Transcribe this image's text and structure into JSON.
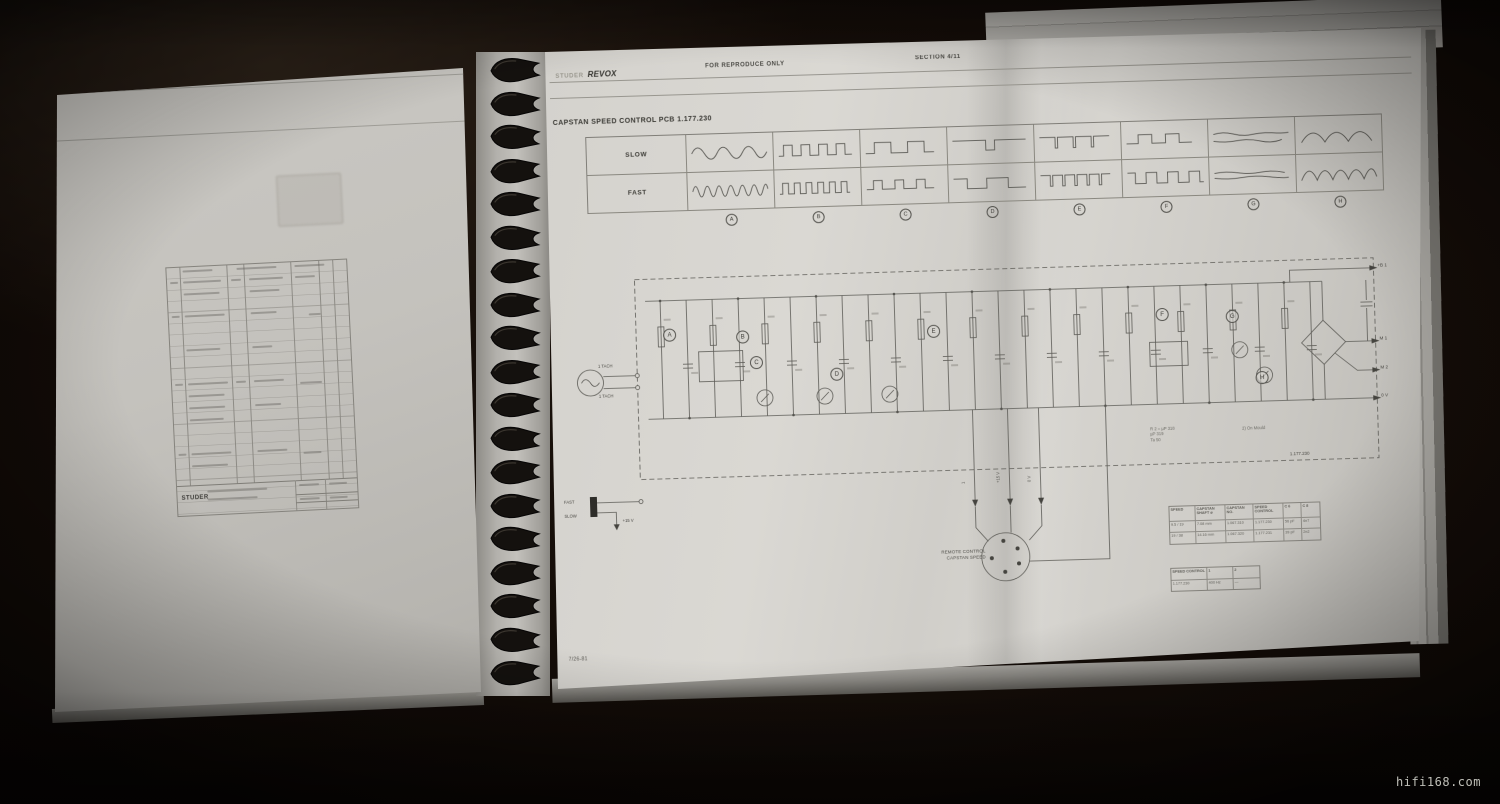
{
  "watermark": "hifi168.com",
  "left_page": {
    "titleblock_brand": "STUDER"
  },
  "right_page": {
    "header": {
      "brand_prefix": "STUDER",
      "brand": "REVOX",
      "center": "FOR REPRODUCE ONLY",
      "section": "SECTION 4/11"
    },
    "title": "CAPSTAN SPEED CONTROL PCB   1.177.230",
    "waveform_table": {
      "row_labels": [
        "SLOW",
        "FAST"
      ],
      "columns": [
        {
          "letter": "A",
          "slow": "sine_slow",
          "fast": "sine_fast"
        },
        {
          "letter": "B",
          "slow": "square_med",
          "fast": "square_fast"
        },
        {
          "letter": "C",
          "slow": "square_wide",
          "fast": "square_pair"
        },
        {
          "letter": "D",
          "slow": "square_long",
          "fast": "square_wide2"
        },
        {
          "letter": "E",
          "slow": "pulse_sparse",
          "fast": "pulse_dense"
        },
        {
          "letter": "F",
          "slow": "square_wide3",
          "fast": "square_med2"
        },
        {
          "letter": "G",
          "slow": "flat_wavy",
          "fast": "flat_wavy2"
        },
        {
          "letter": "H",
          "slow": "humps_slow",
          "fast": "humps_fast"
        }
      ]
    },
    "schematic": {
      "board_label": "1.177.230",
      "test_points": [
        "A",
        "B",
        "C",
        "D",
        "E",
        "F",
        "G",
        "H"
      ],
      "right_pins": [
        "+B 1",
        "M 1",
        "M 2",
        "0 V"
      ],
      "left_labels": {
        "tacho_top": "1 TACH",
        "tacho_bottom": "1 TACH",
        "fast": "FAST",
        "slow": "SLOW",
        "supply": "+15 V"
      },
      "vertical_pin_labels": [
        "1",
        "+15 V",
        "0 V"
      ],
      "connector_label_1": "REMOTE CONTROL",
      "connector_label_2": "CAPSTAN SPEED",
      "notes": {
        "n1": "R 2 = µP 318",
        "n2": "µP 319",
        "n3": "Ta 50",
        "n4": "2)  On Mould"
      }
    },
    "spec_table": {
      "headers": [
        "SPEED",
        "CAPSTAN SHAFT ø",
        "CAPSTAN NO.",
        "SPEED CONTROL",
        "C 6",
        "C 8"
      ],
      "rows": [
        [
          "9.5 / 19",
          "7.08 mm",
          "1.067.310",
          "1.177.230",
          "56 pF",
          "4n7"
        ],
        [
          "19 / 38",
          "14.16 mm",
          "1.067.320",
          "1.177.231",
          "39 pF",
          "2n2"
        ]
      ]
    },
    "control_table": {
      "headers": [
        "SPEED CONTROL",
        "1",
        "2"
      ],
      "rows": [
        [
          "1.177.230",
          "400 Hz",
          "—"
        ]
      ]
    },
    "footer": "7/26-81"
  }
}
